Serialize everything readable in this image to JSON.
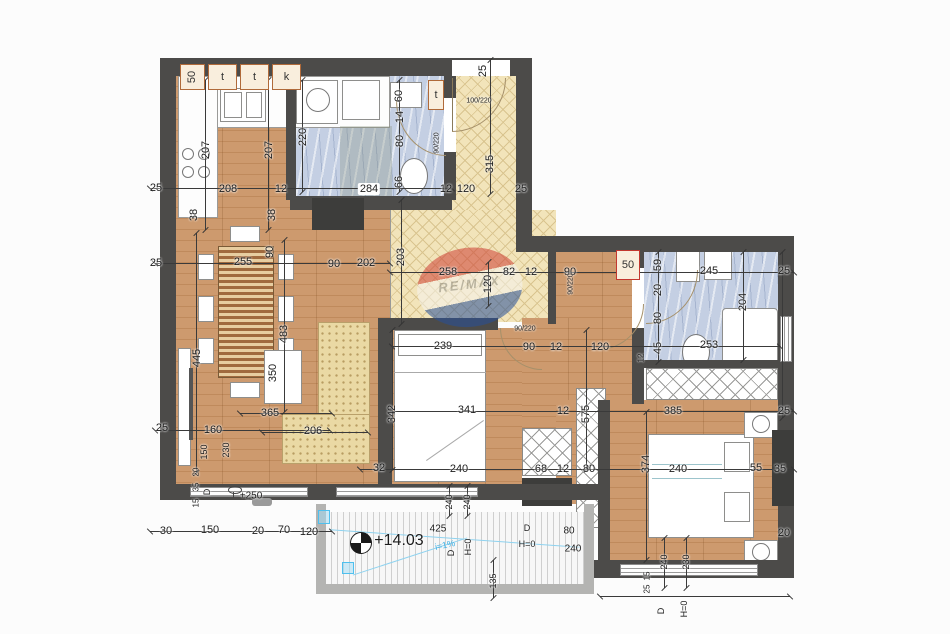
{
  "watermark": {
    "brand": "RE/MAX"
  },
  "colors": {
    "wall": "#4c4b49",
    "wood": "#cd9a6e",
    "tile_cream": "#f2e4ba",
    "tile_blue": "#c4cfe3",
    "accent_red": "#c3372f",
    "slope_blue": "#3fb0e4"
  },
  "tag_boxes": [
    {
      "t": "50",
      "x": 180,
      "y": 64,
      "w": 25,
      "h": 26,
      "rot": true
    },
    {
      "t": "t",
      "x": 208,
      "y": 64,
      "w": 29,
      "h": 26
    },
    {
      "t": "t",
      "x": 240,
      "y": 64,
      "w": 29,
      "h": 26
    },
    {
      "t": "k",
      "x": 272,
      "y": 64,
      "w": 29,
      "h": 26
    },
    {
      "t": "t",
      "x": 428,
      "y": 80,
      "w": 16,
      "h": 30
    },
    {
      "t": "50",
      "x": 616,
      "y": 250,
      "w": 24,
      "h": 30,
      "red": true
    }
  ],
  "labels": [
    {
      "t": "25",
      "x": 156,
      "y": 188
    },
    {
      "t": "208",
      "x": 228,
      "y": 189
    },
    {
      "t": "12",
      "x": 281,
      "y": 189
    },
    {
      "t": "284",
      "x": 369,
      "y": 189,
      "c": "pill"
    },
    {
      "t": "12",
      "x": 446,
      "y": 189
    },
    {
      "t": "207",
      "x": 206,
      "y": 150,
      "r": -90
    },
    {
      "t": "207",
      "x": 269,
      "y": 150,
      "r": -90
    },
    {
      "t": "220",
      "x": 303,
      "y": 137,
      "r": -90
    },
    {
      "t": "38",
      "x": 194,
      "y": 215,
      "r": -90
    },
    {
      "t": "38",
      "x": 272,
      "y": 215,
      "r": -90
    },
    {
      "t": "60",
      "x": 399,
      "y": 96,
      "r": -90
    },
    {
      "t": "14",
      "x": 400,
      "y": 117,
      "r": -90
    },
    {
      "t": "80",
      "x": 400,
      "y": 141,
      "r": -90
    },
    {
      "t": "66",
      "x": 399,
      "y": 182,
      "r": -90
    },
    {
      "t": "25",
      "x": 483,
      "y": 71,
      "r": -90
    },
    {
      "t": "100/220",
      "x": 479,
      "y": 101,
      "s": 7
    },
    {
      "t": "90/220",
      "x": 437,
      "y": 143,
      "s": 7,
      "r": -90
    },
    {
      "t": "315",
      "x": 490,
      "y": 164,
      "r": -90
    },
    {
      "t": "120",
      "x": 466,
      "y": 189
    },
    {
      "t": "25",
      "x": 521,
      "y": 189
    },
    {
      "t": "25",
      "x": 156,
      "y": 263
    },
    {
      "t": "255",
      "x": 243,
      "y": 262
    },
    {
      "t": "90",
      "x": 270,
      "y": 252,
      "r": -90
    },
    {
      "t": "90",
      "x": 334,
      "y": 264
    },
    {
      "t": "202",
      "x": 366,
      "y": 263
    },
    {
      "t": "203",
      "x": 401,
      "y": 257,
      "r": -90
    },
    {
      "t": "445",
      "x": 197,
      "y": 358,
      "r": -90
    },
    {
      "t": "483",
      "x": 284,
      "y": 334,
      "r": -90
    },
    {
      "t": "350",
      "x": 273,
      "y": 373,
      "r": -90
    },
    {
      "t": "365",
      "x": 270,
      "y": 413
    },
    {
      "t": "206",
      "x": 313,
      "y": 431
    },
    {
      "t": "160",
      "x": 213,
      "y": 430
    },
    {
      "t": "150",
      "x": 204,
      "y": 452,
      "r": -90,
      "s": 9
    },
    {
      "t": "230",
      "x": 226,
      "y": 450,
      "r": -90,
      "s": 9
    },
    {
      "t": "25",
      "x": 162,
      "y": 428
    },
    {
      "t": "30",
      "x": 166,
      "y": 531
    },
    {
      "t": "150",
      "x": 210,
      "y": 530
    },
    {
      "t": "20",
      "x": 258,
      "y": 531
    },
    {
      "t": "70",
      "x": 284,
      "y": 530
    },
    {
      "t": "120",
      "x": 309,
      "y": 532
    },
    {
      "t": "20",
      "x": 196,
      "y": 472,
      "r": -90,
      "s": 8
    },
    {
      "t": "35",
      "x": 196,
      "y": 487,
      "r": -90,
      "s": 8
    },
    {
      "t": "15",
      "x": 196,
      "y": 503,
      "r": -90,
      "s": 8
    },
    {
      "t": "D",
      "x": 207,
      "y": 492,
      "r": -90,
      "s": 9
    },
    {
      "t": "+250",
      "x": 251,
      "y": 496,
      "s": 10
    },
    {
      "t": "258",
      "x": 448,
      "y": 272
    },
    {
      "t": "82",
      "x": 509,
      "y": 272
    },
    {
      "t": "12",
      "x": 531,
      "y": 272
    },
    {
      "t": "90",
      "x": 570,
      "y": 272
    },
    {
      "t": "120",
      "x": 488,
      "y": 284,
      "r": -90
    },
    {
      "t": "90/220",
      "x": 525,
      "y": 329,
      "s": 7
    },
    {
      "t": "90/220",
      "x": 571,
      "y": 284,
      "s": 7,
      "r": -90
    },
    {
      "t": "239",
      "x": 443,
      "y": 346
    },
    {
      "t": "90",
      "x": 529,
      "y": 347
    },
    {
      "t": "12",
      "x": 556,
      "y": 347
    },
    {
      "t": "120",
      "x": 600,
      "y": 347
    },
    {
      "t": "341",
      "x": 467,
      "y": 410
    },
    {
      "t": "12",
      "x": 563,
      "y": 411
    },
    {
      "t": "342",
      "x": 392,
      "y": 414,
      "r": -90
    },
    {
      "t": "575",
      "x": 586,
      "y": 414,
      "r": -90
    },
    {
      "t": "32",
      "x": 379,
      "y": 468
    },
    {
      "t": "240",
      "x": 459,
      "y": 469
    },
    {
      "t": "68",
      "x": 541,
      "y": 469
    },
    {
      "t": "12",
      "x": 563,
      "y": 469
    },
    {
      "t": "80",
      "x": 589,
      "y": 469
    },
    {
      "t": "374",
      "x": 646,
      "y": 464,
      "r": -90
    },
    {
      "t": "240",
      "x": 678,
      "y": 469
    },
    {
      "t": "55",
      "x": 756,
      "y": 468
    },
    {
      "t": "35",
      "x": 780,
      "y": 469
    },
    {
      "t": "59",
      "x": 658,
      "y": 265,
      "r": -90
    },
    {
      "t": "245",
      "x": 709,
      "y": 271
    },
    {
      "t": "25",
      "x": 784,
      "y": 271
    },
    {
      "t": "20",
      "x": 658,
      "y": 290,
      "r": -90
    },
    {
      "t": "80",
      "x": 658,
      "y": 318,
      "r": -90
    },
    {
      "t": "45",
      "x": 658,
      "y": 348,
      "r": -90
    },
    {
      "t": "204",
      "x": 743,
      "y": 302,
      "r": -90
    },
    {
      "t": "253",
      "x": 709,
      "y": 345
    },
    {
      "t": "12",
      "x": 641,
      "y": 358,
      "r": -90,
      "s": 8
    },
    {
      "t": "385",
      "x": 673,
      "y": 411
    },
    {
      "t": "25",
      "x": 784,
      "y": 411
    },
    {
      "t": "240",
      "x": 449,
      "y": 502,
      "r": -90,
      "s": 9
    },
    {
      "t": "240",
      "x": 467,
      "y": 502,
      "r": -90,
      "s": 9
    },
    {
      "t": "+14.03",
      "x": 399,
      "y": 541,
      "s": 16
    },
    {
      "t": "425",
      "x": 438,
      "y": 529,
      "s": 10
    },
    {
      "t": "i=1%",
      "x": 445,
      "y": 545,
      "s": 9,
      "r": -12,
      "c": "blue"
    },
    {
      "t": "D",
      "x": 451,
      "y": 553,
      "r": -90,
      "s": 9
    },
    {
      "t": "H=0",
      "x": 468,
      "y": 547,
      "r": -90,
      "s": 9
    },
    {
      "t": "D",
      "x": 527,
      "y": 528,
      "s": 9
    },
    {
      "t": "H=0",
      "x": 527,
      "y": 544,
      "s": 9
    },
    {
      "t": "80",
      "x": 569,
      "y": 531,
      "s": 10
    },
    {
      "t": "240",
      "x": 573,
      "y": 549,
      "s": 10
    },
    {
      "t": "135",
      "x": 493,
      "y": 581,
      "r": -90,
      "s": 9
    },
    {
      "t": "15",
      "x": 647,
      "y": 576,
      "r": -90,
      "s": 8
    },
    {
      "t": "25",
      "x": 647,
      "y": 589,
      "r": -90,
      "s": 8
    },
    {
      "t": "240",
      "x": 664,
      "y": 562,
      "r": -90,
      "s": 9
    },
    {
      "t": "230",
      "x": 686,
      "y": 562,
      "r": -90,
      "s": 9
    },
    {
      "t": "20",
      "x": 784,
      "y": 533
    },
    {
      "t": "D",
      "x": 661,
      "y": 611,
      "r": -90,
      "s": 9
    },
    {
      "t": "H=0",
      "x": 684,
      "y": 609,
      "r": -90,
      "s": 9
    }
  ],
  "dim_lines": [
    {
      "o": "h",
      "x": 150,
      "y": 188,
      "l": 302
    },
    {
      "o": "h",
      "x": 155,
      "y": 263,
      "l": 235
    },
    {
      "o": "h",
      "x": 390,
      "y": 272,
      "l": 404
    },
    {
      "o": "h",
      "x": 392,
      "y": 346,
      "l": 388
    },
    {
      "o": "h",
      "x": 392,
      "y": 411,
      "l": 402
    },
    {
      "o": "h",
      "x": 155,
      "y": 430,
      "l": 175
    },
    {
      "o": "h",
      "x": 240,
      "y": 413,
      "l": 92
    },
    {
      "o": "h",
      "x": 262,
      "y": 432,
      "l": 106
    },
    {
      "o": "h",
      "x": 360,
      "y": 469,
      "l": 434
    },
    {
      "o": "h",
      "x": 150,
      "y": 531,
      "l": 182
    },
    {
      "o": "h",
      "x": 600,
      "y": 596,
      "l": 190
    },
    {
      "o": "v",
      "x": 205,
      "y": 80,
      "l": 150
    },
    {
      "o": "v",
      "x": 268,
      "y": 80,
      "l": 150
    },
    {
      "o": "v",
      "x": 302,
      "y": 80,
      "l": 112
    },
    {
      "o": "v",
      "x": 399,
      "y": 80,
      "l": 112
    },
    {
      "o": "v",
      "x": 490,
      "y": 60,
      "l": 134
    },
    {
      "o": "v",
      "x": 196,
      "y": 233,
      "l": 240
    },
    {
      "o": "v",
      "x": 284,
      "y": 240,
      "l": 172
    },
    {
      "o": "v",
      "x": 401,
      "y": 200,
      "l": 124
    },
    {
      "o": "v",
      "x": 488,
      "y": 262,
      "l": 44
    },
    {
      "o": "v",
      "x": 658,
      "y": 252,
      "l": 110
    },
    {
      "o": "v",
      "x": 743,
      "y": 252,
      "l": 108
    },
    {
      "o": "v",
      "x": 392,
      "y": 330,
      "l": 140
    },
    {
      "o": "v",
      "x": 586,
      "y": 330,
      "l": 140
    },
    {
      "o": "v",
      "x": 646,
      "y": 412,
      "l": 148
    },
    {
      "o": "v",
      "x": 449,
      "y": 486,
      "l": 30
    },
    {
      "o": "v",
      "x": 467,
      "y": 486,
      "l": 30
    },
    {
      "o": "v",
      "x": 493,
      "y": 560,
      "l": 38
    },
    {
      "o": "v",
      "x": 664,
      "y": 538,
      "l": 50
    },
    {
      "o": "v",
      "x": 686,
      "y": 538,
      "l": 50
    },
    {
      "o": "v",
      "x": 782,
      "y": 252,
      "l": 166
    }
  ]
}
